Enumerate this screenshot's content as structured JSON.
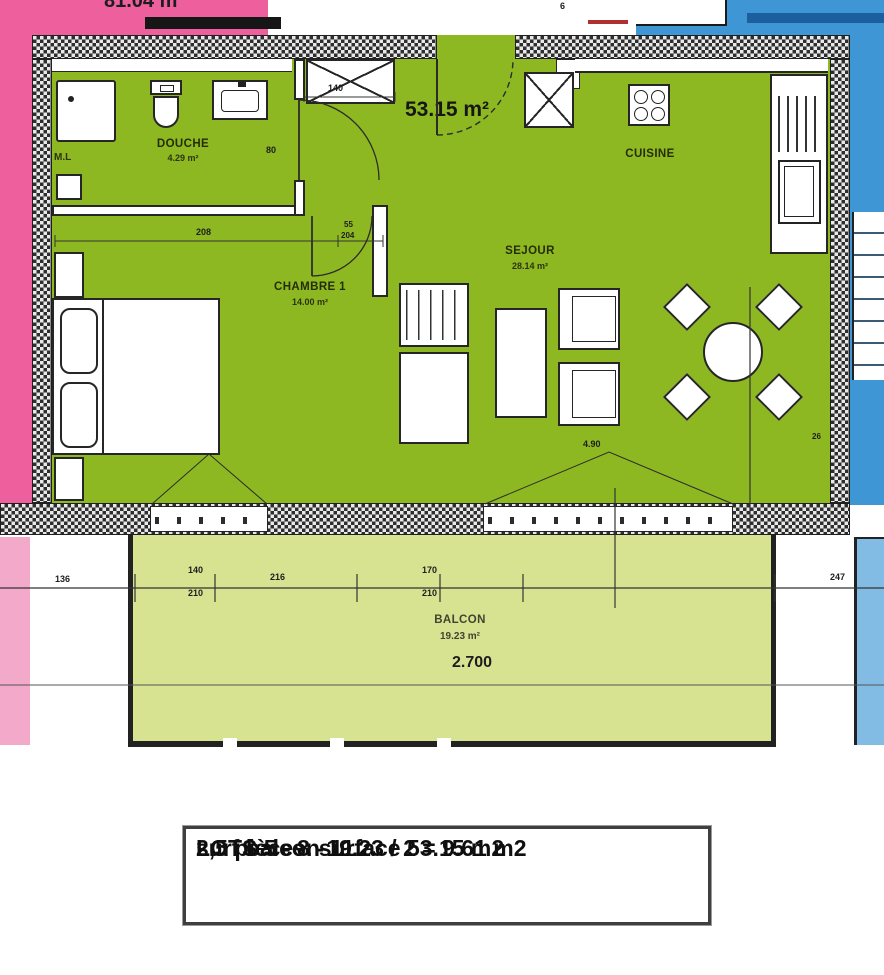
{
  "areas": {
    "neighbor_left": "81.04 m²",
    "apartment_total": "53.15 m²"
  },
  "rooms": {
    "douche": {
      "name": "DOUCHE",
      "area": "4.29 m²"
    },
    "chambre": {
      "name": "CHAMBRE 1",
      "area": "14.00 m²"
    },
    "sejour": {
      "name": "SEJOUR",
      "area": "28.14 m²"
    },
    "cuisine": {
      "name": "CUISINE"
    },
    "balcon": {
      "name": "BALCON",
      "area": "19.23 m²",
      "width_dim": "2.700"
    }
  },
  "appliances": {
    "washing_machine": "M.L"
  },
  "legend_box": {
    "line1": "LOTS  5 - 8 - 11",
    "line2": "2,5 pièces. surface 53.15 m2",
    "line3": "surf balcon  19.23 / 2 = 9.61 m2"
  },
  "annotations": [
    {
      "text": "208",
      "x": 196,
      "y": 228,
      "size": 9
    },
    {
      "text": "55",
      "x": 344,
      "y": 221,
      "size": 8
    },
    {
      "text": "204",
      "x": 341,
      "y": 232,
      "size": 8
    },
    {
      "text": "140",
      "x": 328,
      "y": 84,
      "size": 9
    },
    {
      "text": "80",
      "x": 266,
      "y": 146,
      "size": 9
    },
    {
      "text": "4.90",
      "x": 583,
      "y": 440,
      "size": 9
    },
    {
      "text": "26",
      "x": 812,
      "y": 433,
      "size": 8
    },
    {
      "text": "6",
      "x": 560,
      "y": 2,
      "size": 9
    },
    {
      "text": "136",
      "x": 55,
      "y": 575,
      "size": 9
    },
    {
      "text": "140",
      "x": 188,
      "y": 566,
      "size": 9
    },
    {
      "text": "210",
      "x": 188,
      "y": 589,
      "size": 9
    },
    {
      "text": "216",
      "x": 270,
      "y": 573,
      "size": 9
    },
    {
      "text": "170",
      "x": 422,
      "y": 566,
      "size": 9
    },
    {
      "text": "210",
      "x": 422,
      "y": 589,
      "size": 9
    },
    {
      "text": "247",
      "x": 830,
      "y": 573,
      "size": 9
    }
  ],
  "colors": {
    "apartment_green": "#8eb822",
    "balcony_green": "#d8e392",
    "neighbor_pink": "#ee5f9e",
    "neighbor_pink_light": "#f3a9ca",
    "neighbor_blue": "#3e97d4",
    "neighbor_blue_light": "#82bbe4",
    "wall_dark": "#2a2a2a",
    "line_dark": "#333333"
  }
}
